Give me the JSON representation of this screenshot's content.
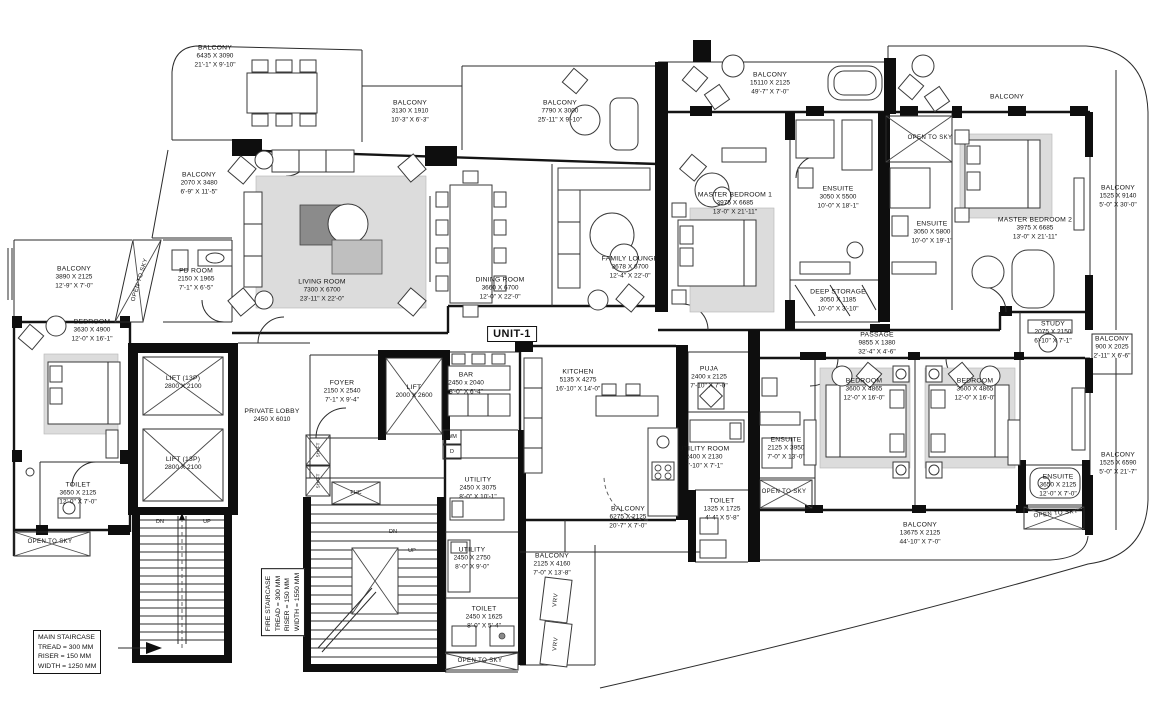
{
  "unit_label": "UNIT-1",
  "colors": {
    "line": "#141414",
    "paper": "#ffffff",
    "halftone": "#dcdcdc"
  },
  "notes": {
    "main_staircase": {
      "l1": "MAIN STAIRCASE",
      "l2": "TREAD = 300 MM",
      "l3": "RISER  = 150 MM",
      "l4": "WIDTH = 1250 MM"
    },
    "fire_staircase": {
      "l1": "FIRE STAIRCASE",
      "l2": "TREAD = 300 MM",
      "l3": "RISER  = 150 MM",
      "l4": "WIDTH = 1550 MM"
    }
  },
  "misc": {
    "open_to_sky": "OPEN TO SKY",
    "dn": "DN",
    "up": "UP",
    "fhc": "FHC",
    "wm": "WM",
    "d": "D",
    "vrv": "VRV",
    "shaft": "SHAFT"
  },
  "rooms": {
    "balcony_tl": {
      "name": "BALCONY",
      "mm": "6435 X 3090",
      "ft": "21'-1\" X 9'-10\""
    },
    "balcony_3130": {
      "name": "BALCONY",
      "mm": "3130 X 1910",
      "ft": "10'-3\" X 6'-3\""
    },
    "balcony_7790": {
      "name": "BALCONY",
      "mm": "7790 X 3000",
      "ft": "25'-11\" X 9'-10\""
    },
    "balcony_15110": {
      "name": "BALCONY",
      "mm": "15110 X 2125",
      "ft": "49'-7\" X 7'-0\""
    },
    "balcony_tr": {
      "name": "BALCONY"
    },
    "balcony_r_9140": {
      "name": "BALCONY",
      "mm": "1525 X 9140",
      "ft": "5'-0\" X 30'-0\""
    },
    "balcony_2070": {
      "name": "BALCONY",
      "mm": "2070 X 3480",
      "ft": "6'-9\" X 11'-5\""
    },
    "balcony_3890": {
      "name": "BALCONY",
      "mm": "3890 X 2125",
      "ft": "12'-9\" X 7'-0\""
    },
    "pd_room": {
      "name": "PD ROOM",
      "mm": "2150 X 1965",
      "ft": "7'-1\" X 6'-5\""
    },
    "living_room": {
      "name": "LIVING ROOM",
      "mm": "7300 X 6700",
      "ft": "23'-11\" X 22'-0\""
    },
    "dining_room": {
      "name": "DINING ROOM",
      "mm": "3660 X 6700",
      "ft": "12'-0\" X 22'-0\""
    },
    "family_lounge": {
      "name": "FAMILY LOUNGE",
      "mm": "3678 X 6700",
      "ft": "12'-4\" X 22'-0\""
    },
    "master_bedroom_1": {
      "name": "MASTER BEDROOM 1",
      "mm": "3975 X 6685",
      "ft": "13'-0\" X 21'-11\""
    },
    "ensuite_m1": {
      "name": "ENSUITE",
      "mm": "3050 X 5500",
      "ft": "10'-0\" X 18'-1\""
    },
    "ensuite_m2": {
      "name": "ENSUITE",
      "mm": "3050 X 5800",
      "ft": "10'-0\" X 19'-1\""
    },
    "master_bedroom_2": {
      "name": "MASTER BEDROOM 2",
      "mm": "3975 X 6685",
      "ft": "13'-0\" X 21'-11\""
    },
    "deep_storage": {
      "name": "DEEP STORAGE",
      "mm": "3050 X 1185",
      "ft": "10'-0\" X 3'-10\""
    },
    "study": {
      "name": "STUDY",
      "mm": "2075 X 2150",
      "ft": "6'-10\" X 7'-1\""
    },
    "balcony_900": {
      "name": "BALCONY",
      "mm": "900 X 2025",
      "ft": "2'-11\" X 6'-6\""
    },
    "bar": {
      "name": "BAR",
      "mm": "2450 x 2040",
      "ft": "8'-0\" X 6'-4\""
    },
    "kitchen": {
      "name": "KITCHEN",
      "mm": "5135 X 4275",
      "ft": "16'-10\" X 14'-0\""
    },
    "puja": {
      "name": "PUJA",
      "mm": "2400 x 2125",
      "ft": "7'-10\" X 7'-0\""
    },
    "passage": {
      "name": "PASSAGE",
      "mm": "9855 X 1380",
      "ft": "32'-4\" X 4'-6\""
    },
    "bedroom_3": {
      "name": "BEDROOM",
      "mm": "3600 X 4865",
      "ft": "12'-0\" X 16'-0\""
    },
    "bedroom_4": {
      "name": "BEDROOM",
      "mm": "3600 X 4865",
      "ft": "12'-0\" X 16'-0\""
    },
    "bedroom_2": {
      "name": "BEDROOM",
      "mm": "3630 X 4900",
      "ft": "12'-0\" X 16'-1\""
    },
    "lift_a": {
      "name": "LIFT (13P)",
      "mm": "2800 X 2100"
    },
    "lift_b": {
      "name": "LIFT (13P)",
      "mm": "2800 X 2100"
    },
    "private_lobby": {
      "name": "PRIVATE LOBBY",
      "mm": "2450 X 6010"
    },
    "foyer": {
      "name": "FOYER",
      "mm": "2150 X 2540",
      "ft": "7'-1\" X 9'-4\""
    },
    "lift_c": {
      "name": "LIFT",
      "mm": "2000 X 2600"
    },
    "toilet_2": {
      "name": "TOILET",
      "mm": "3650 X 2125",
      "ft": "12'-0\" X 7'-0\""
    },
    "utility_1": {
      "name": "UTILITY",
      "mm": "2450 X 3075",
      "ft": "8'-0\" X 10'-1\""
    },
    "utility_room": {
      "name": "UTILITY ROOM",
      "mm": "2400 X 2130",
      "ft": "7'-10\" X 7'-1\""
    },
    "ensuite_b3": {
      "name": "ENSUITE",
      "mm": "2125 X 3950",
      "ft": "7'-0\" X 13'-0\""
    },
    "toilet_3": {
      "name": "TOILET",
      "mm": "1325 X 1725",
      "ft": "4'-4\" X 5'-8\""
    },
    "ensuite_b4": {
      "name": "ENSUITE",
      "mm": "3650 X 2125",
      "ft": "12'-0\" X 7'-0\""
    },
    "balcony_13675": {
      "name": "BALCONY",
      "mm": "13675 X 2125",
      "ft": "44'-10\" X 7'-0\""
    },
    "balcony_r_6590": {
      "name": "BALCONY",
      "mm": "1525 X 6590",
      "ft": "5'-0\" X 21'-7\""
    },
    "balcony_6275": {
      "name": "BALCONY",
      "mm": "6275 X 2125",
      "ft": "20'-7\" X 7'-0\""
    },
    "balcony_4160": {
      "name": "BALCONY",
      "mm": "2125 X 4160",
      "ft": "7'-0\" X 13'-8\""
    },
    "utility_2": {
      "name": "UTILITY",
      "mm": "2450 X 2750",
      "ft": "8'-0\" X 9'-0\""
    },
    "toilet_1625": {
      "name": "TOILET",
      "mm": "2450 X 1625",
      "ft": "8'-0\" X 5'-4\""
    }
  }
}
